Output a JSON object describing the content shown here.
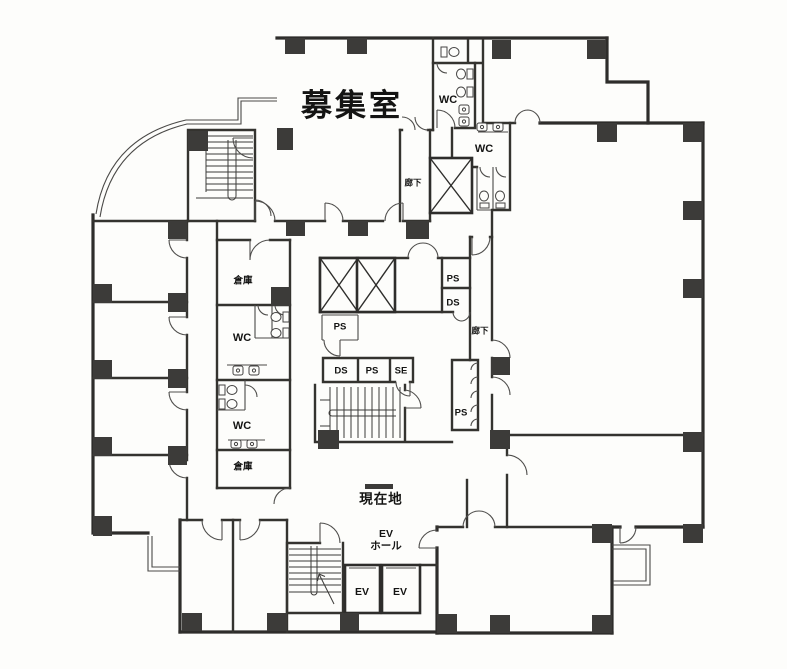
{
  "plan": {
    "labels": {
      "main_room": "募集室",
      "wc_top": "WC",
      "wc_mid": "WC",
      "corridor_top": "廊下",
      "corridor_right": "廊下",
      "storage_upper": "倉庫",
      "storage_lower": "倉庫",
      "ps_shaft": "PS",
      "ds_shaft": "DS",
      "ps_small": "PS",
      "ds_row": "DS",
      "ps_row": "PS",
      "se_row": "SE",
      "wc_left_upper": "WC",
      "wc_left_lower": "WC",
      "ps_tall": "PS",
      "current_location": "現在地",
      "ev_hall_line1": "EV",
      "ev_hall_line2": "ホール",
      "ev_car_left": "EV",
      "ev_car_right": "EV"
    },
    "colors": {
      "wall": "#2e2d2b",
      "pier": "#3c3b39",
      "paper": "#fdfdfb",
      "ink": "#141413"
    }
  }
}
